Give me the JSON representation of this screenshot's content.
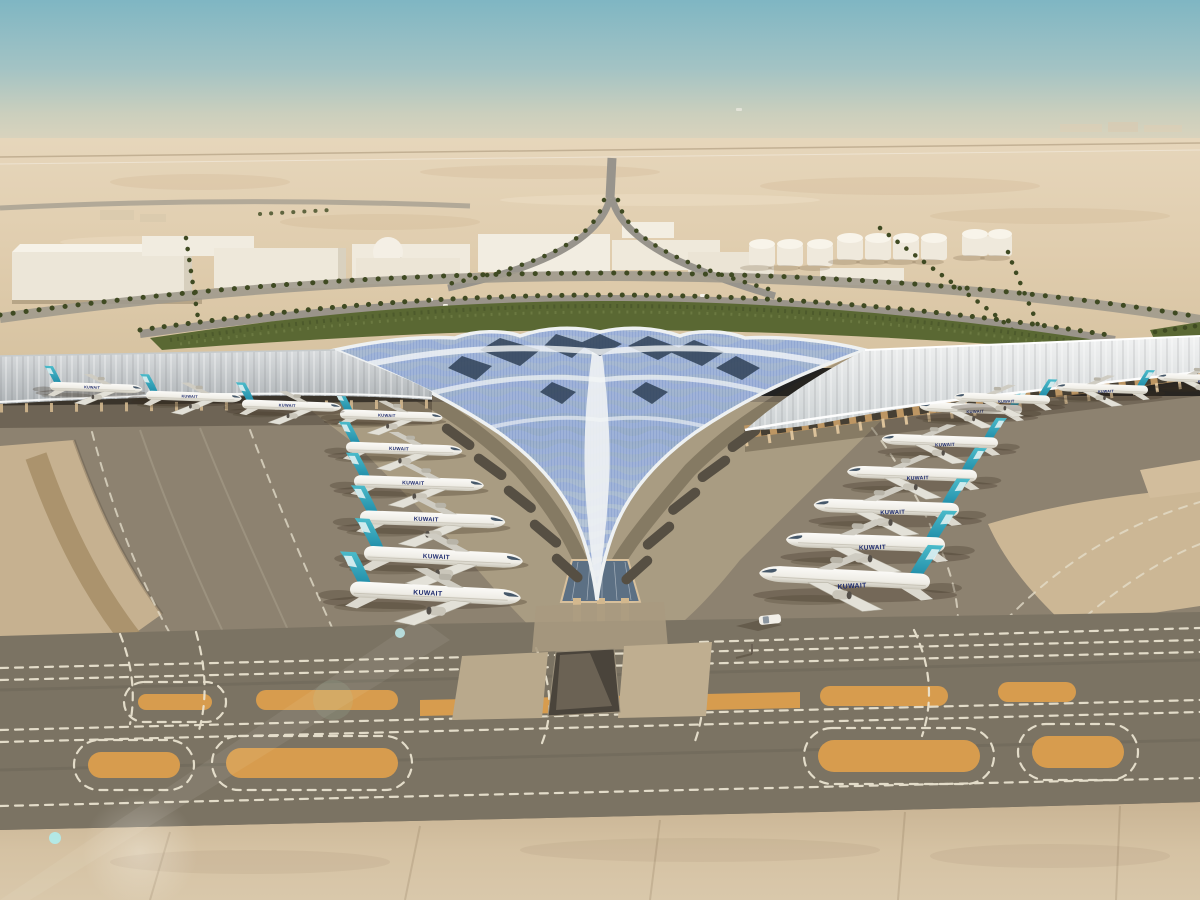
{
  "scene": {
    "airline_label": "KUWAIT",
    "colors": {
      "sky_top": "#7fb6c3",
      "sky_haze": "#e0d5bd",
      "desert": "#e2d0b2",
      "sand_foreground": "#cdb897",
      "apron_gray": "#8d8270",
      "taxiway_dark": "#7b7363",
      "island_orange": "#d79c4e",
      "marking_white": "#ece5d2",
      "greenery": "#5a6833",
      "roof_white": "#eef1f2",
      "roof_glass_blue": "#8fa6d4",
      "tail_teal": "#2aa2b9",
      "facade_amber": "#bd9663",
      "fuselage_white": "#f4f3ee",
      "titles_navy": "#1d2a6e"
    },
    "counts": {
      "aircraft_left_pier": 6,
      "aircraft_right_pier": 6,
      "aircraft_left_wing": 4,
      "aircraft_right_wing": 3,
      "storage_tanks": 9
    },
    "aircraft_layout": {
      "left_pier": [
        {
          "x": 340,
          "y": 414,
          "s": 0.6,
          "r": 2,
          "m": 0
        },
        {
          "x": 346,
          "y": 447,
          "s": 0.68,
          "r": 2,
          "m": 0
        },
        {
          "x": 354,
          "y": 481,
          "s": 0.76,
          "r": 2,
          "m": 0
        },
        {
          "x": 360,
          "y": 517,
          "s": 0.85,
          "r": 2,
          "m": 0
        },
        {
          "x": 364,
          "y": 553,
          "s": 0.93,
          "r": 3,
          "m": 0
        },
        {
          "x": 350,
          "y": 589,
          "s": 1.0,
          "r": 3,
          "m": 0
        }
      ],
      "right_pier": [
        {
          "x": 1022,
          "y": 410,
          "s": 0.6,
          "r": 2,
          "m": 1
        },
        {
          "x": 998,
          "y": 443,
          "s": 0.68,
          "r": 2,
          "m": 1
        },
        {
          "x": 977,
          "y": 476,
          "s": 0.76,
          "r": 2,
          "m": 1
        },
        {
          "x": 959,
          "y": 510,
          "s": 0.85,
          "r": 2,
          "m": 1
        },
        {
          "x": 945,
          "y": 545,
          "s": 0.93,
          "r": 2,
          "m": 1
        },
        {
          "x": 930,
          "y": 582,
          "s": 1.0,
          "r": 3,
          "m": 1
        }
      ],
      "left_wing": [
        {
          "x": -104,
          "y": 374,
          "s": 0.56,
          "r": 2,
          "m": 0
        },
        {
          "x": 50,
          "y": 386,
          "s": 0.54,
          "r": 2,
          "m": 0
        },
        {
          "x": 146,
          "y": 395,
          "s": 0.56,
          "r": 2,
          "m": 0
        },
        {
          "x": 242,
          "y": 404,
          "s": 0.58,
          "r": 2,
          "m": 0
        }
      ],
      "right_wing": [
        {
          "x": 1050,
          "y": 400,
          "s": 0.56,
          "r": 2,
          "m": 1
        },
        {
          "x": 1148,
          "y": 390,
          "s": 0.54,
          "r": 2,
          "m": 1
        },
        {
          "x": 1246,
          "y": 380,
          "s": 0.52,
          "r": 2,
          "m": 1
        }
      ]
    }
  }
}
